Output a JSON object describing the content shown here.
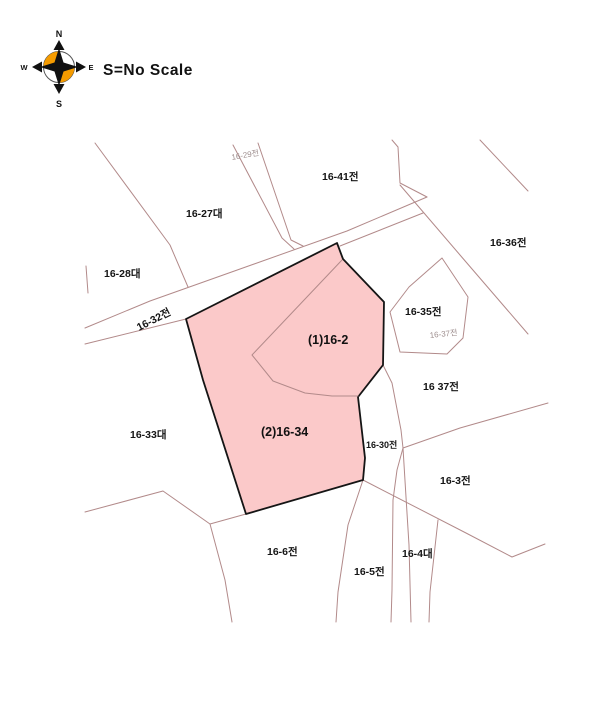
{
  "scale_note": "S=No Scale",
  "compass": {
    "n": "N",
    "s": "S",
    "e": "E",
    "w": "W"
  },
  "colors": {
    "boundary_line": "#b28a8a",
    "highlight_fill": "#fbc9c9",
    "highlight_outline": "#151515",
    "label": "#151515",
    "muted_label": "#9d8d8d",
    "compass_orange": "#f59b00"
  },
  "parcels": {
    "p1627": "16-27대",
    "p1628": "16-28대",
    "p1629": "16-29전",
    "p1632": "16-32전",
    "p1633": "16-33대",
    "p1641": "16-41전",
    "p1636": "16-36전",
    "p1635": "16-35전",
    "p1637_small": "16-37전",
    "p1637": "16 37전",
    "p1630": "16-30전",
    "p163": "16-3전",
    "p166": "16-6전",
    "p165": "16-5전",
    "p164": "16-4대",
    "highlight_a": "(1)16-2",
    "highlight_b": "(2)16-34"
  }
}
